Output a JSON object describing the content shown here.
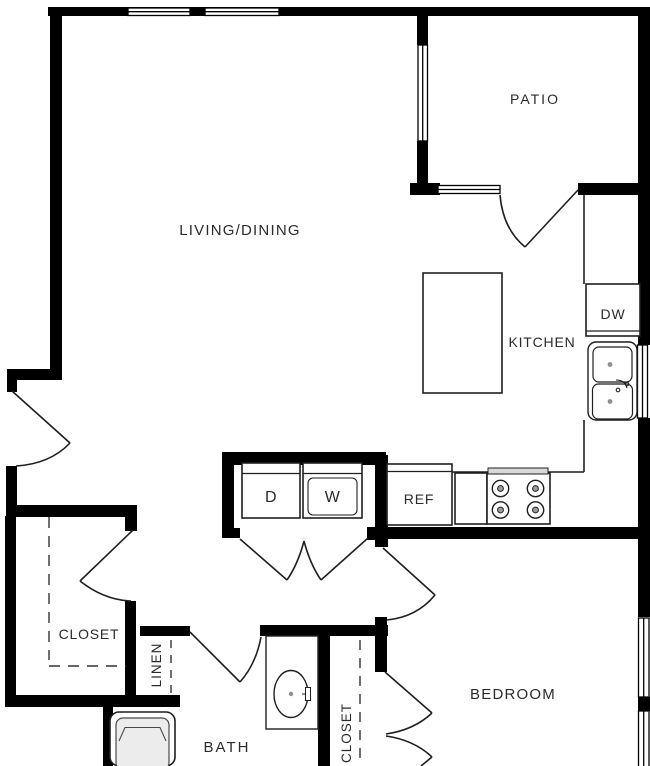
{
  "plan": {
    "title": "apartment-floor-plan",
    "rooms": {
      "living_dining": "LIVING/DINING",
      "patio": "PATIO",
      "kitchen": "KITCHEN",
      "bedroom": "BEDROOM",
      "bath": "BATH",
      "closet": "CLOSET",
      "bedroom_closet": "CLOSET",
      "linen": "LINEN"
    },
    "appliances": {
      "dishwasher": "DW",
      "dryer": "D",
      "washer": "W",
      "refrigerator": "REF"
    },
    "colors": {
      "wall": "#000000",
      "line": "#1f1f1f",
      "text": "#2b2b2b",
      "tub_fill": "#ececec",
      "stove_back": "#d8d8d8",
      "background": "#ffffff"
    }
  }
}
